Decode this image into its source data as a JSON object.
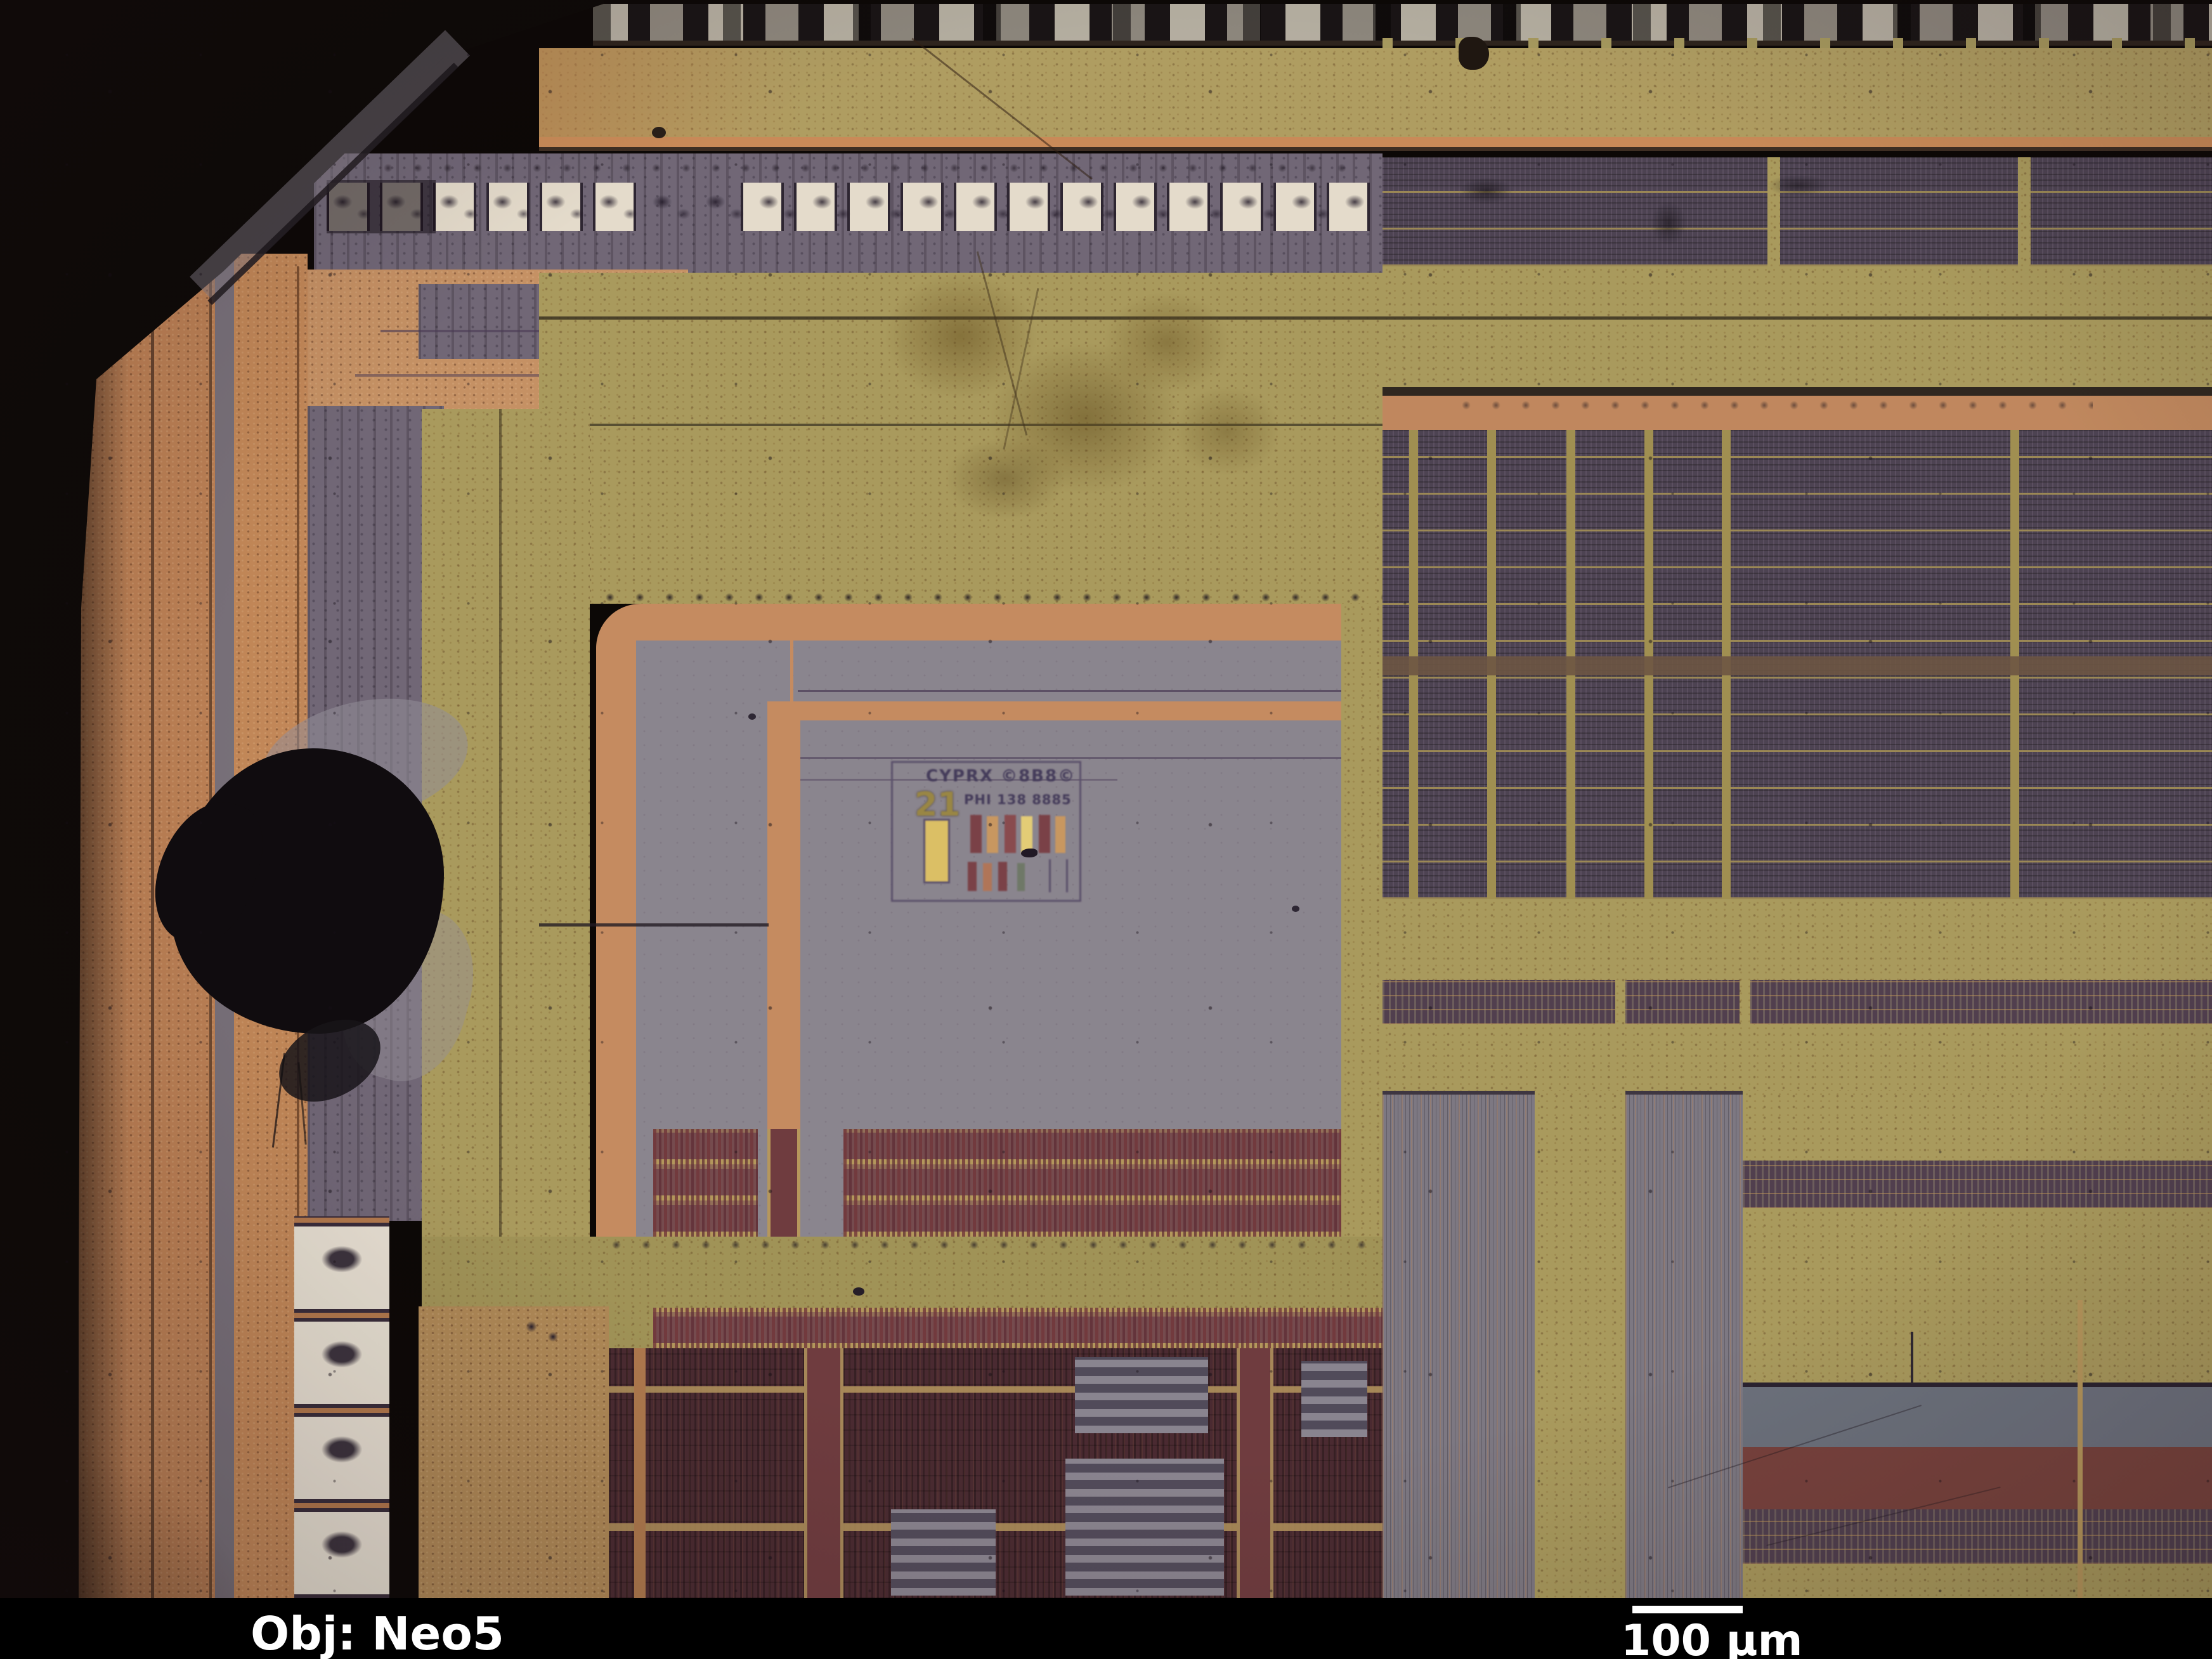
{
  "capture": {
    "kind": "microscope die photograph",
    "overlay": {
      "objective_label": "Obj: Neo5",
      "scale_bar_label": "100 µm"
    }
  },
  "die_marking": {
    "number": "21",
    "line1": "CYPRX ©8B8©",
    "line2": "PHI 138 8885"
  },
  "structures": {
    "top_pad_row_count": 18,
    "left_pad_column_count": 4,
    "bottom_left_probe_pad_count": 4
  },
  "palette": {
    "background_black": "#060404",
    "info_bar_black": "#000000",
    "label_white": "#ffffff",
    "seal_khaki": "#b2a164",
    "copper": "#c08357",
    "salmon_ring": "#c98e62",
    "orange_line": "#cd8d5a",
    "pad_strip_purple": "#70687a",
    "core_gray": "#8b8793",
    "array_dark": "#4a4254",
    "array_line_tan": "#9c8b57",
    "cell_row_tan": "#b69a5e",
    "cell_row_maroon": "#744a50",
    "bottom_maroon": "#472831",
    "olive_band": "#a29659",
    "pad_white": "#e9e2d3",
    "blue_band": "#6b7280",
    "red_band": "#77413d",
    "marking_yellow": "#e0c468",
    "defect_black": "#0a080d"
  }
}
